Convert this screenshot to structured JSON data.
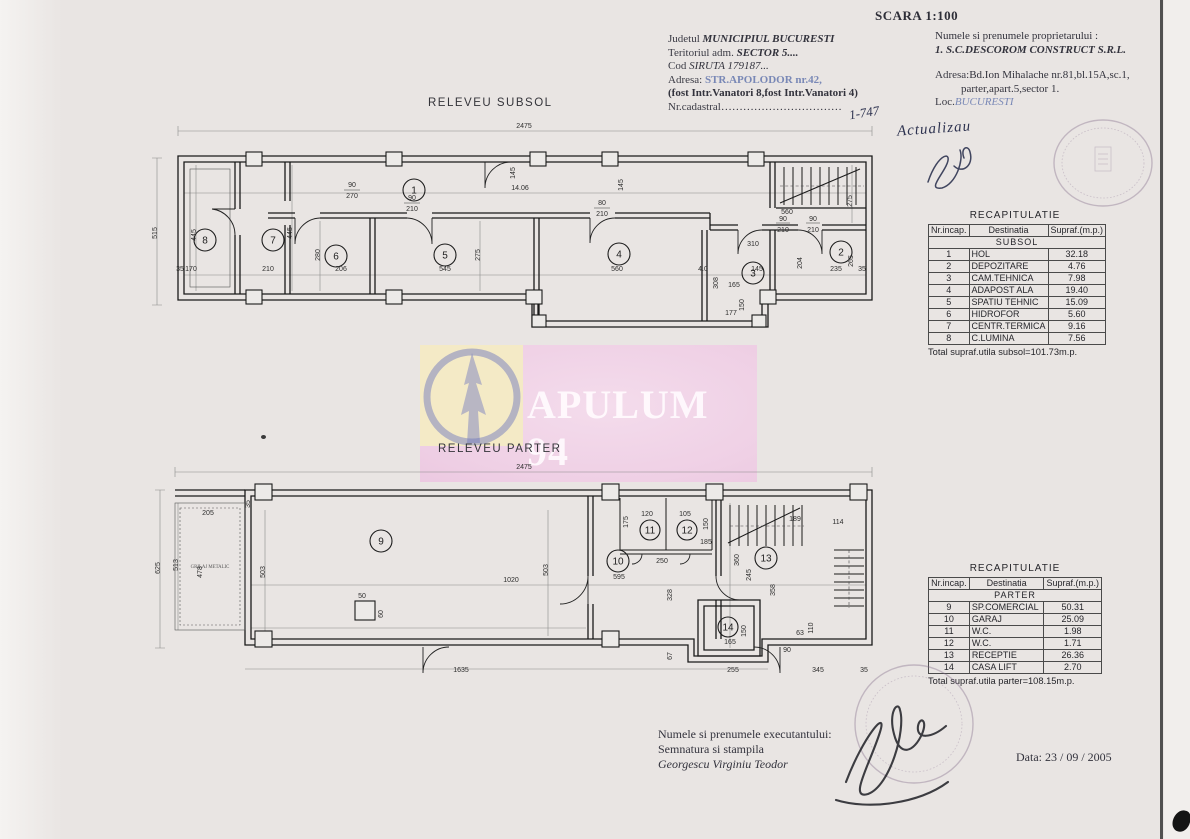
{
  "page": {
    "scale": "SCARA 1:100",
    "date": "Data: 23 / 09 / 2005"
  },
  "header_left": {
    "lines": [
      {
        "label": "Judetul",
        "value": "MUNICIPIUL BUCURESTI"
      },
      {
        "label": "Teritoriul adm.",
        "value": "SECTOR 5...."
      },
      {
        "label": "Cod",
        "value": "SIRUTA 179187..."
      },
      {
        "label": "Adresa:",
        "value": "STR.APOLODOR nr.42,"
      },
      {
        "label": "",
        "value": "(fost Intr.Vanatori 8,fost Intr.Vanatori 4)"
      },
      {
        "label": "Nr.cadastral",
        "value": "……………………………"
      }
    ]
  },
  "header_right": {
    "lines": [
      {
        "label": "",
        "value": "Numele si prenumele proprietarului :"
      },
      {
        "label": "",
        "value": "1. S.C.DESCOROM CONSTRUCT S.R.L."
      },
      {
        "label": "Adresa:",
        "value": "Bd.Ion Mihalache nr.81,bl.15A,sc.1,"
      },
      {
        "label": "",
        "value": "parter,apart.5,sector 1."
      },
      {
        "label": "Loc.",
        "value": "BUCURESTI"
      }
    ]
  },
  "annotations": {
    "cadastral_note": "1-747",
    "update_note": "Actualizau"
  },
  "watermark": {
    "text": "APULUM 94"
  },
  "plans": {
    "subsol": {
      "title": "RELEVEU SUBSOL",
      "rooms": [
        "1",
        "2",
        "3",
        "4",
        "5",
        "6",
        "7",
        "8"
      ],
      "dims": {
        "total_w": "2475",
        "total_h": "515",
        "d445": "445",
        "d170": "170",
        "d210": "210",
        "d206": "206",
        "d545": "545",
        "d560": "560",
        "d1406": "14.06",
        "d90": "90",
        "d270": "270",
        "d80": "80",
        "d145": "145",
        "d275": "275",
        "d280": "280",
        "d310": "310",
        "d235": "235",
        "d204": "204",
        "d265": "265",
        "d165": "165",
        "d150": "150",
        "d177": "177",
        "d308": "308",
        "d35": "35",
        "d40": "4.0"
      }
    },
    "parter": {
      "title": "RELEVEU PARTER",
      "note": "GRILAJ METALIC",
      "rooms": [
        "9",
        "10",
        "11",
        "12",
        "13",
        "14"
      ],
      "dims": {
        "total_w": "2475",
        "d625": "625",
        "d513": "513",
        "d205": "205",
        "d478": "478",
        "d503": "503",
        "d1020": "1020",
        "d595": "595",
        "d250": "250",
        "d120": "120",
        "d105": "105",
        "d175": "175",
        "d360": "360",
        "d245": "245",
        "d358": "358",
        "d150": "150",
        "d165": "165",
        "d63": "63",
        "d110": "110",
        "d90": "90",
        "d255": "255",
        "d345": "345",
        "d1635": "1635",
        "d50": "50",
        "d60": "60",
        "d328": "328",
        "d67": "67",
        "d185": "185",
        "d189": "189",
        "d114": "114",
        "d35": "35"
      }
    }
  },
  "tables": {
    "subsol": {
      "title": "RECAPITULATIE",
      "columns": [
        "Nr.incap.",
        "Destinatia",
        "Supraf.(m.p.)"
      ],
      "section": "SUBSOL",
      "rows": [
        [
          "1",
          "HOL",
          "32.18"
        ],
        [
          "2",
          "DEPOZITARE",
          "4.76"
        ],
        [
          "3",
          "CAM.TEHNICA",
          "7.98"
        ],
        [
          "4",
          "ADAPOST ALA",
          "19.40"
        ],
        [
          "5",
          "SPATIU TEHNIC",
          "15.09"
        ],
        [
          "6",
          "HIDROFOR",
          "5.60"
        ],
        [
          "7",
          "CENTR.TERMICA",
          "9.16"
        ],
        [
          "8",
          "C.LUMINA",
          "7.56"
        ]
      ],
      "total": "Total supraf.utila subsol=101.73m.p."
    },
    "parter": {
      "title": "RECAPITULATIE",
      "columns": [
        "Nr.incap.",
        "Destinatia",
        "Supraf.(m.p.)"
      ],
      "section": "PARTER",
      "rows": [
        [
          "9",
          "SP.COMERCIAL",
          "50.31"
        ],
        [
          "10",
          "GARAJ",
          "25.09"
        ],
        [
          "11",
          "W.C.",
          "1.98"
        ],
        [
          "12",
          "W.C.",
          "1.71"
        ],
        [
          "13",
          "RECEPTIE",
          "26.36"
        ],
        [
          "14",
          "CASA LIFT",
          "2.70"
        ]
      ],
      "total": "Total supraf.utila parter=108.15m.p."
    }
  },
  "footer": {
    "lines": [
      "Numele si prenumele executantului:",
      "Semnatura si stampila",
      "Georgescu Virginiu Teodor"
    ]
  }
}
